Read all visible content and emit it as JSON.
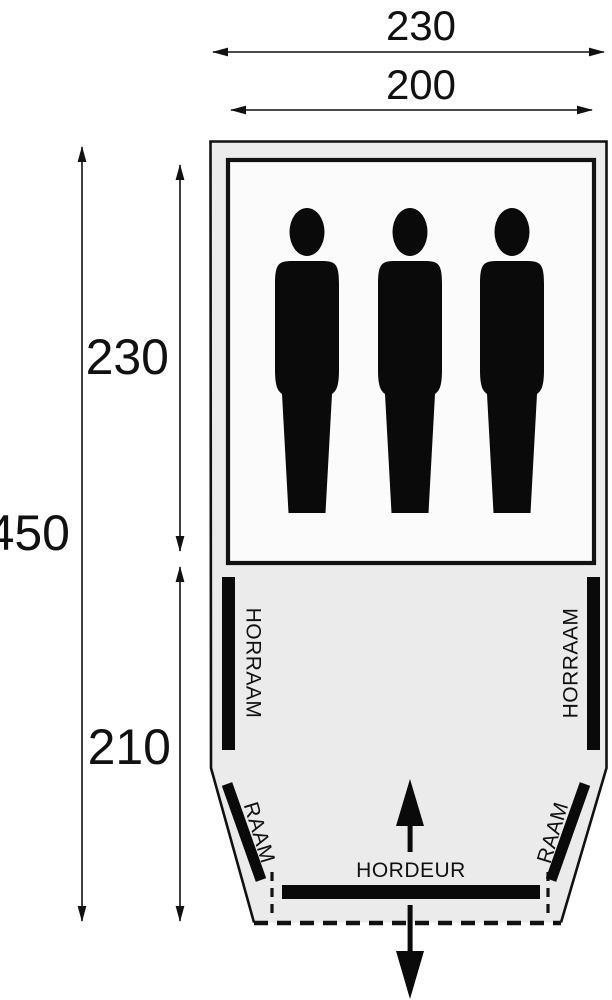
{
  "diagram": {
    "title": "tent-floorplan",
    "dims": {
      "top_outer_width": "230",
      "top_inner_width": "200",
      "left_total_depth": "450",
      "left_cabin_depth": "230",
      "left_porch_depth": "210"
    },
    "labels": {
      "horraam_left": "HORRAAM",
      "horraam_right": "HORRAAM",
      "raam_left": "RAAM",
      "raam_right": "RAAM",
      "hordeur": "HORDEUR"
    },
    "person_count": 3,
    "colors": {
      "line_black": "#111111",
      "tent_fill": "#ebebeb",
      "cabin_fill": "#fbfbfb",
      "figure_black": "#0a0a0a"
    }
  }
}
